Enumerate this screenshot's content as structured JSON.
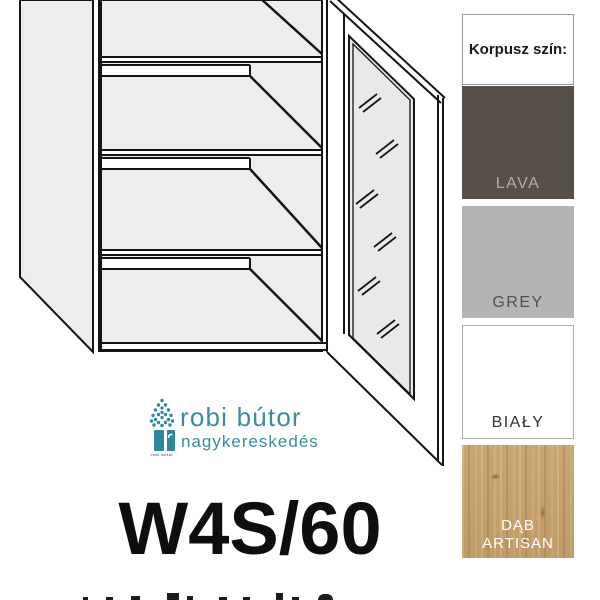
{
  "product": {
    "code": "W4S/60"
  },
  "logo": {
    "title": "robi bútor",
    "subtitle": "nagykereskedés",
    "icon_caption": "robi bútor",
    "accent_color": "#3c8ba0"
  },
  "color_panel": {
    "header": "Korpusz szín:",
    "swatches": [
      {
        "label": "LAVA",
        "color": "#575049",
        "label_color": "#b3ada8"
      },
      {
        "label": "GREY",
        "color": "#b5b4b4",
        "label_color": "#4f4f4f"
      },
      {
        "label": "BIAŁY",
        "color": "#ffffff",
        "label_color": "#333333"
      },
      {
        "label": "DĄB ARTISAN",
        "color": "#c7a36e",
        "label_color": "#ffffff"
      }
    ]
  },
  "illustration": {
    "description": "wall cabinet line drawing, open glass door, 3 shelves",
    "fill_color": "#ededed",
    "line_color": "#151515"
  }
}
